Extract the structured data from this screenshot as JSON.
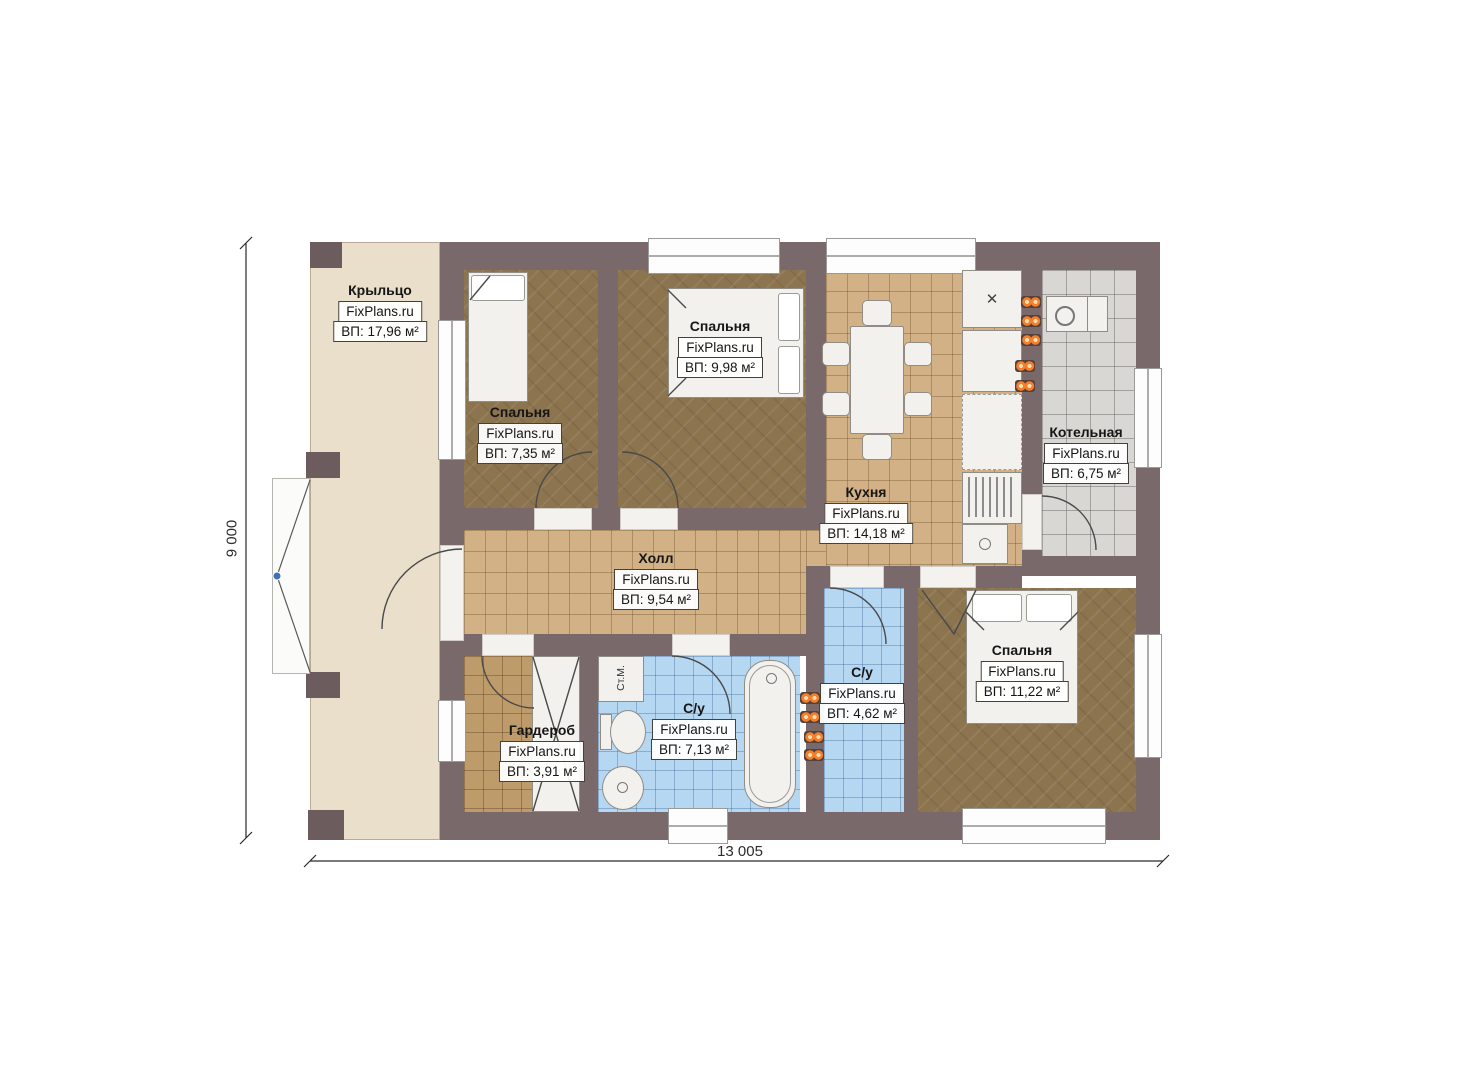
{
  "plan": {
    "source_watermark": "FixPlans.ru",
    "rooms": [
      {
        "name": "Крыльцо",
        "brand": "FixPlans.ru",
        "area": "ВП: 17,96 м²"
      },
      {
        "name": "Спальня",
        "brand": "FixPlans.ru",
        "area": "ВП: 7,35 м²"
      },
      {
        "name": "Спальня",
        "brand": "FixPlans.ru",
        "area": "ВП: 9,98 м²"
      },
      {
        "name": "Кухня",
        "brand": "FixPlans.ru",
        "area": "ВП: 14,18 м²"
      },
      {
        "name": "Котельная",
        "brand": "FixPlans.ru",
        "area": "ВП: 6,75 м²"
      },
      {
        "name": "Холл",
        "brand": "FixPlans.ru",
        "area": "ВП: 9,54 м²"
      },
      {
        "name": "Гардероб",
        "brand": "FixPlans.ru",
        "area": "ВП: 3,91 м²"
      },
      {
        "name": "С/у",
        "brand": "FixPlans.ru",
        "area": "ВП: 7,13 м²"
      },
      {
        "name": "С/у",
        "brand": "FixPlans.ru",
        "area": "ВП: 4,62 м²"
      },
      {
        "name": "Спальня",
        "brand": "FixPlans.ru",
        "area": "ВП: 11,22 м²"
      }
    ],
    "labels": {
      "washing_machine": "Ст.М."
    },
    "dimensions": {
      "height_label": "9 000",
      "width_label": "13 005"
    },
    "colors": {
      "wall": "#7a696b",
      "porch_floor": "#e9dfca",
      "wood_floor": "#8c744f",
      "tile_floor": "#d3b186",
      "wardrobe_floor": "#bd9b6b",
      "bath_tile": "#b5d7f2",
      "boiler_tile": "#d8d7d3",
      "radiator_accent": "#f57f2c"
    }
  }
}
